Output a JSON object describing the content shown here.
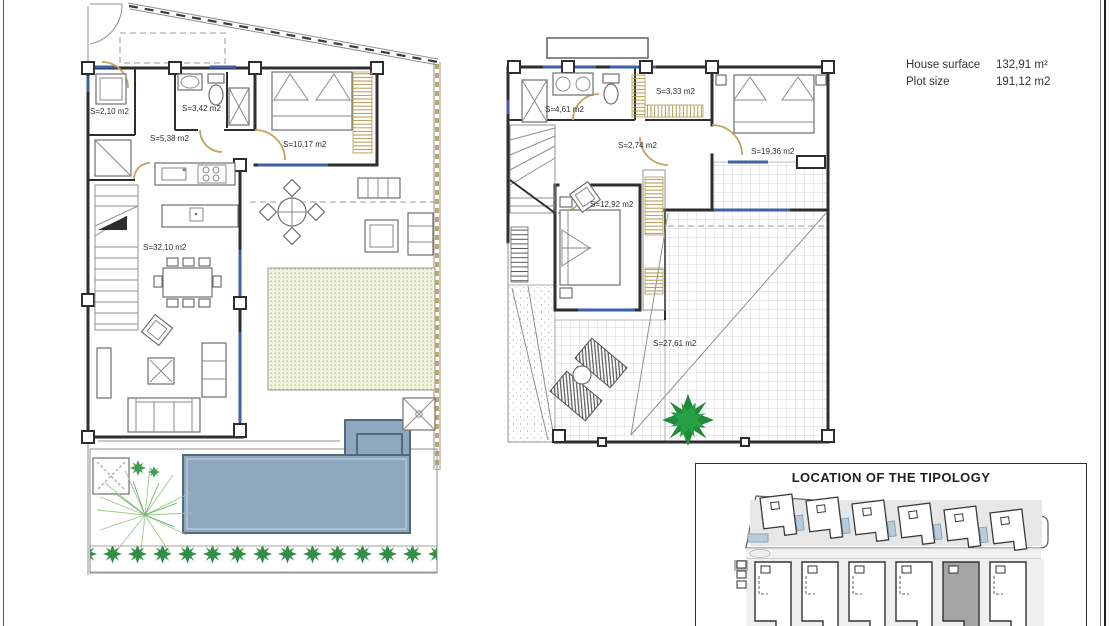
{
  "header": {
    "house_surface_label": "House surface",
    "house_surface_value": "132,91 m²",
    "plot_size_label": "Plot size",
    "plot_size_value": "191,12 m2"
  },
  "ground_floor": {
    "rooms": [
      {
        "id": "utility",
        "label": "S=2,10 m2"
      },
      {
        "id": "bathroom",
        "label": "S=3,42 m2"
      },
      {
        "id": "hall",
        "label": "S=5,38 m2"
      },
      {
        "id": "bedroom",
        "label": "S=10,17 m2"
      },
      {
        "id": "living-kitchen",
        "label": "S=32,10 m2"
      }
    ]
  },
  "first_floor": {
    "rooms": [
      {
        "id": "bathroom",
        "label": "S=4,61 m2"
      },
      {
        "id": "wardrobe",
        "label": "S=3,33 m2"
      },
      {
        "id": "landing",
        "label": "S=2,74 m2"
      },
      {
        "id": "bedroom-1",
        "label": "S=19,36 m2"
      },
      {
        "id": "bedroom-2",
        "label": "S=12,92 m2"
      },
      {
        "id": "terrace",
        "label": "S=27,61 m2"
      }
    ]
  },
  "location_inset": {
    "title": "LOCATION OF THE TIPOLOGY",
    "top_row_house_count": 6,
    "bottom_row_house_count": 6,
    "highlighted_house_row": "bottom",
    "highlighted_house_index_from_left": 5
  },
  "colors": {
    "wall": "#2e2e2e",
    "line_gray": "#909090",
    "door_tan": "#c2a35f",
    "window_blue": "#3c61a5",
    "wardrobe_gold": "#b3994d",
    "garden_fill": "#f0f3dc",
    "garden_dot": "#79a659",
    "hedge_green": "#2f8f46",
    "plant_light_green": "#9cc98c",
    "palm_green": "#1e8a3a",
    "pool_fill": "#8ea9bf",
    "pool_edge": "#53697c",
    "tile_line": "#c9c9c9",
    "site_pool": "#b7cddd",
    "highlight_unit": "#a5a5a5",
    "text_dark": "#333333"
  }
}
